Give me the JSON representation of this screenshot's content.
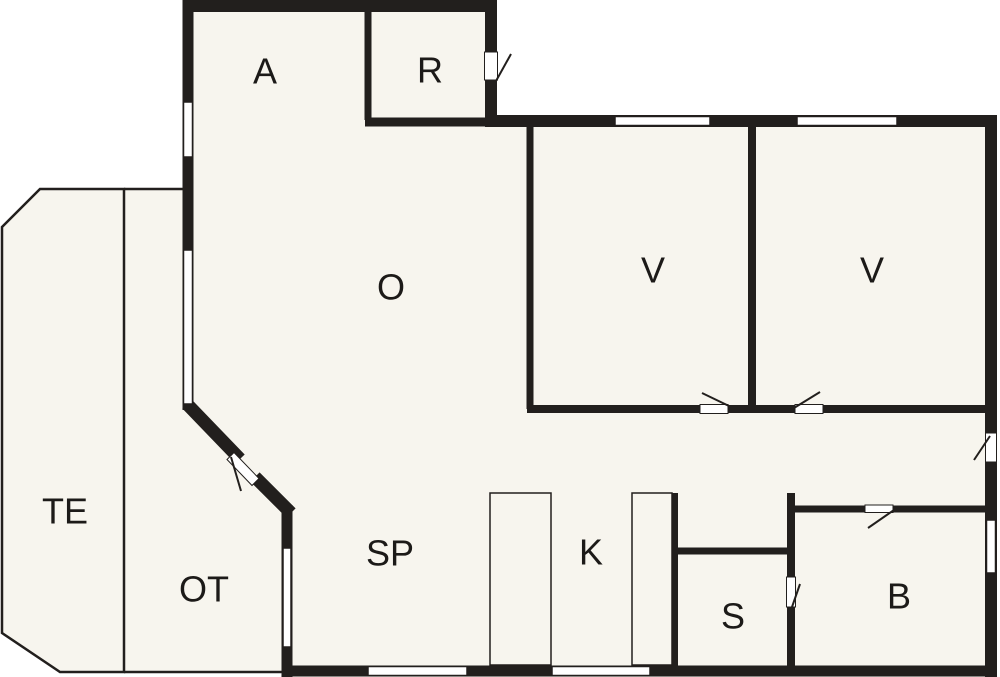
{
  "canvas": {
    "width": 1000,
    "height": 677
  },
  "colors": {
    "background": "#ffffff",
    "floor": "#f7f5ee",
    "wall": "#221f1d",
    "window_fill": "#ffffff",
    "label": "#1c1a18"
  },
  "rooms": {
    "a": {
      "label": "A"
    },
    "r": {
      "label": "R"
    },
    "o": {
      "label": "O"
    },
    "v1": {
      "label": "V"
    },
    "v2": {
      "label": "V"
    },
    "te": {
      "label": "TE"
    },
    "ot": {
      "label": "OT"
    },
    "sp": {
      "label": "SP"
    },
    "k": {
      "label": "K"
    },
    "s": {
      "label": "S"
    },
    "b": {
      "label": "B"
    }
  }
}
